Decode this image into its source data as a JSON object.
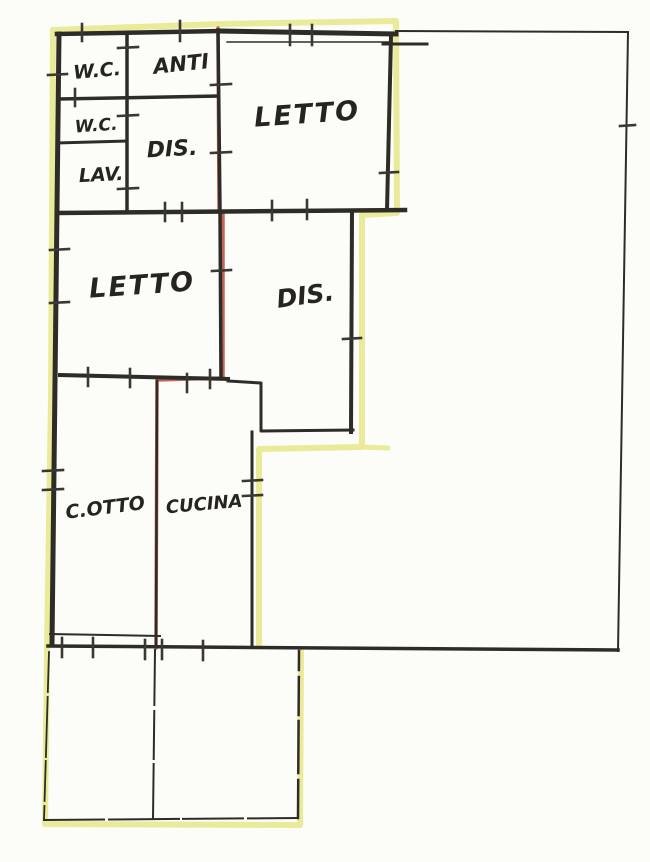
{
  "plan": {
    "type": "hand-drawn cadastral floor plan (scan)",
    "rooms": {
      "wc1": {
        "label": "W.C."
      },
      "anti": {
        "label": "ANTI"
      },
      "wc2": {
        "label": "W.C."
      },
      "dis_top": {
        "label": "DIS."
      },
      "lav": {
        "label": "LAV."
      },
      "letto_top": {
        "label": "LETTO"
      },
      "letto_mid": {
        "label": "LETTO"
      },
      "dis_mid": {
        "label": "DIS."
      },
      "cotto": {
        "label": "C.OTTO"
      },
      "cucina": {
        "label": "CUCINA"
      }
    }
  },
  "colors": {
    "paper": "#fcfcf9",
    "ink": "#26241f",
    "wall": "#2e2c27",
    "thin_line": "#3a3832",
    "highlight_yellow": "#e3e57b",
    "highlight_red": "#b54a41"
  }
}
